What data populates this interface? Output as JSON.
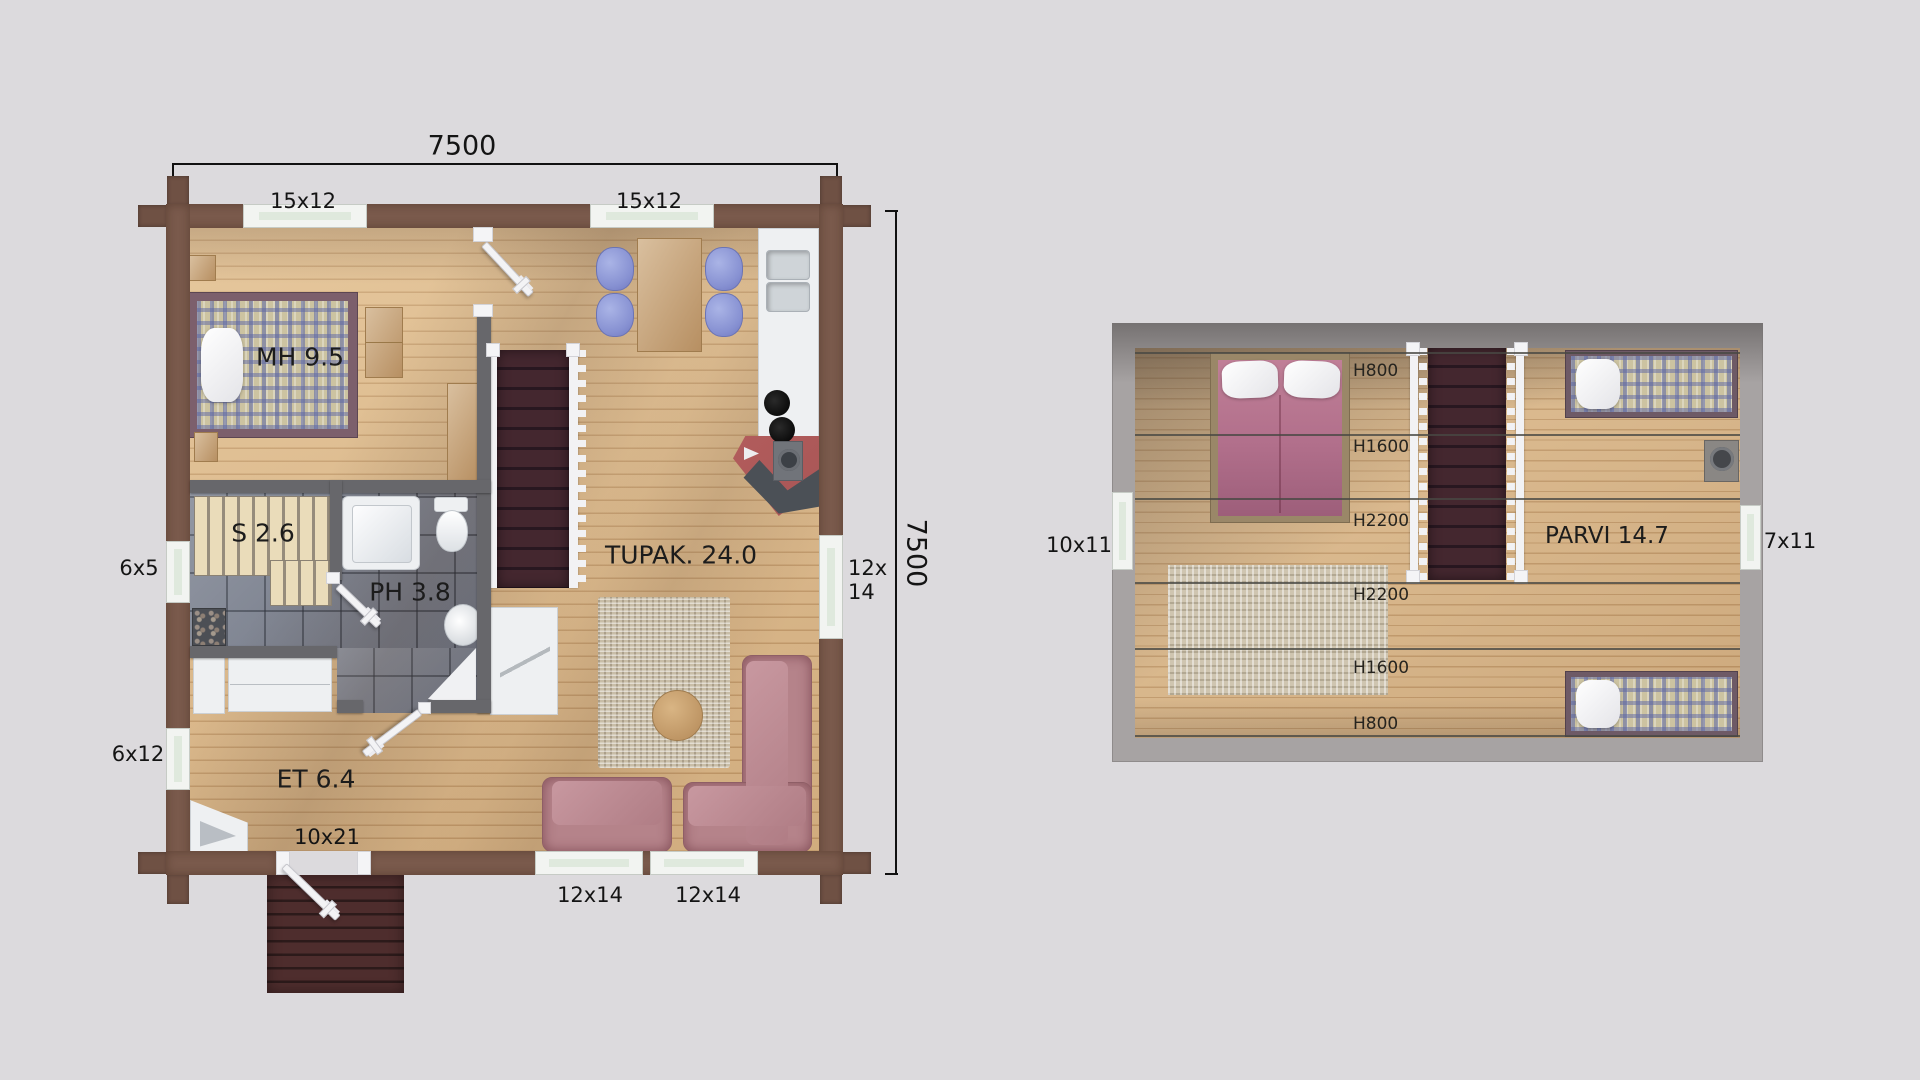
{
  "scene": {
    "title": "log-cabin-floor-plans"
  },
  "colors": {
    "bg": "#dcdadd",
    "wall": "#7a5a4c",
    "wall_dark": "#6f5144",
    "partition": "#67676b",
    "wood": "#deba8b",
    "tile": "#818795",
    "slat": "#eadcba",
    "stairs": "#44272f",
    "deck": "#4e2d2d",
    "table": "#c9a475",
    "sofa": "#b5838a",
    "rug": "#c8bda7",
    "plaid_base": "#ccc3a1",
    "duvet": "#b16f8b",
    "fire_red": "#a85656",
    "roof": "#a7a3a3",
    "glass": "#dfe9dd",
    "label": "#141414",
    "chair_blue": "#8f9bd9"
  },
  "ground_floor": {
    "dimensions": {
      "top": "7500",
      "right": "7500"
    },
    "window_labels": {
      "top_left": "15x12",
      "top_right": "15x12",
      "left_upper": "6x5",
      "left_lower": "6x12",
      "right_line1": "12x",
      "right_line2": "14",
      "bottom_left": "12x14",
      "bottom_right": "12x14",
      "entry_door": "10x21"
    },
    "rooms": {
      "bedroom": "MH 9.5",
      "sauna": "S 2.6",
      "bathroom": "PH 3.8",
      "living": "TUPAK. 24.0",
      "entry": "ET 6.4"
    }
  },
  "upper_floor": {
    "room": "PARVI 14.7",
    "window_labels": {
      "left": "10x11",
      "right": "7x11"
    },
    "height_lines": [
      {
        "label": "H800"
      },
      {
        "label": "H1600"
      },
      {
        "label": "H2200"
      },
      {
        "label": "H2200"
      },
      {
        "label": "H1600"
      },
      {
        "label": "H800"
      }
    ]
  }
}
